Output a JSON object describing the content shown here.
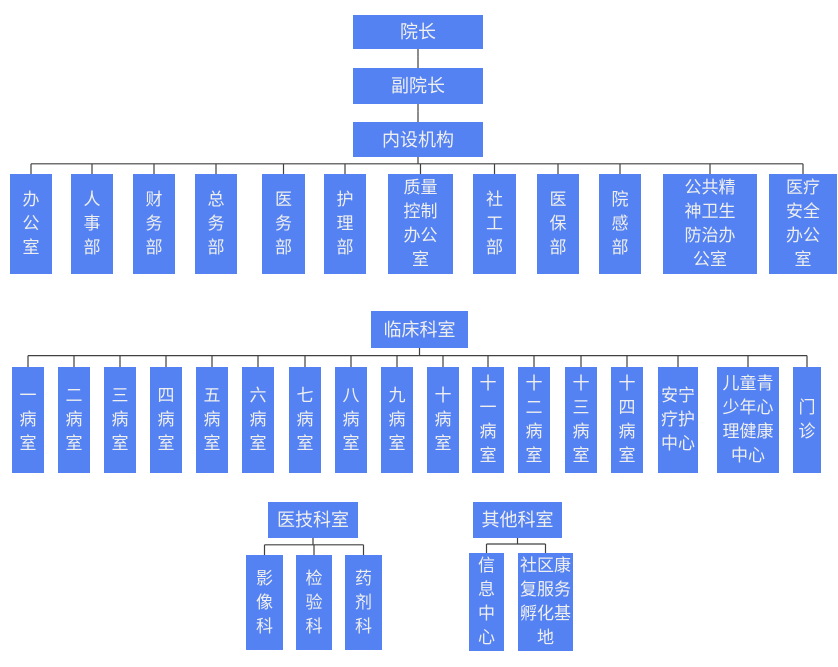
{
  "palette": {
    "node_bg": "#5482F2",
    "node_text": "#EFEFEF",
    "line_color": "#404040",
    "page_bg": "#FFFFFF"
  },
  "org": {
    "root_chain": [
      "院长",
      "副院长",
      "内设机构"
    ],
    "departments": [
      "办公室",
      "人事部",
      "财务部",
      "总务部",
      "医务部",
      "护理部",
      "质量控制办公室",
      "社工部",
      "医保部",
      "院感部",
      "公共精神卫生防治办公室",
      "医疗安全办公室"
    ],
    "clinical": {
      "title": "临床科室",
      "children": [
        "一病室",
        "二病室",
        "三病室",
        "四病室",
        "五病室",
        "六病室",
        "七病室",
        "八病室",
        "九病室",
        "十病室",
        "十一病室",
        "十二病室",
        "十三病室",
        "十四病室",
        "安宁疗护中心",
        "儿童青少年心理健康中心",
        "门诊"
      ]
    },
    "medtech": {
      "title": "医技科室",
      "children": [
        "影像科",
        "检验科",
        "药剂科"
      ]
    },
    "other": {
      "title": "其他科室",
      "children": [
        "信息中心",
        "社区康复服务孵化基地"
      ]
    }
  }
}
